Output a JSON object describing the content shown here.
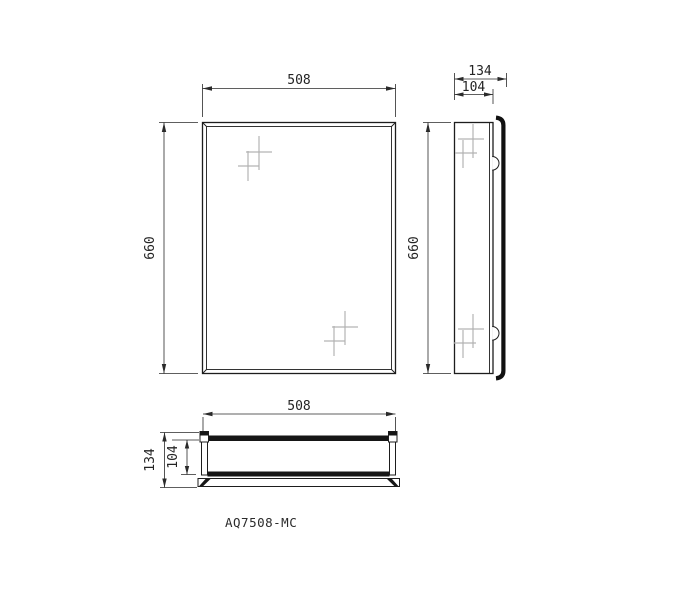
{
  "model_code": "AQ7508-MC",
  "colors": {
    "background": "#ffffff",
    "line": "#1d1d1d",
    "dimension_line": "#2a2a2a",
    "sparkle": "#b3b3b3",
    "door_fill": "#111111"
  },
  "views": {
    "front": {
      "width_dim": "508",
      "height_dim": "660"
    },
    "side": {
      "height_dim": "660",
      "total_depth_dim": "134",
      "body_depth_dim": "104"
    },
    "plan": {
      "width_dim": "508",
      "total_depth_dim": "134",
      "body_depth_dim": "104"
    }
  }
}
